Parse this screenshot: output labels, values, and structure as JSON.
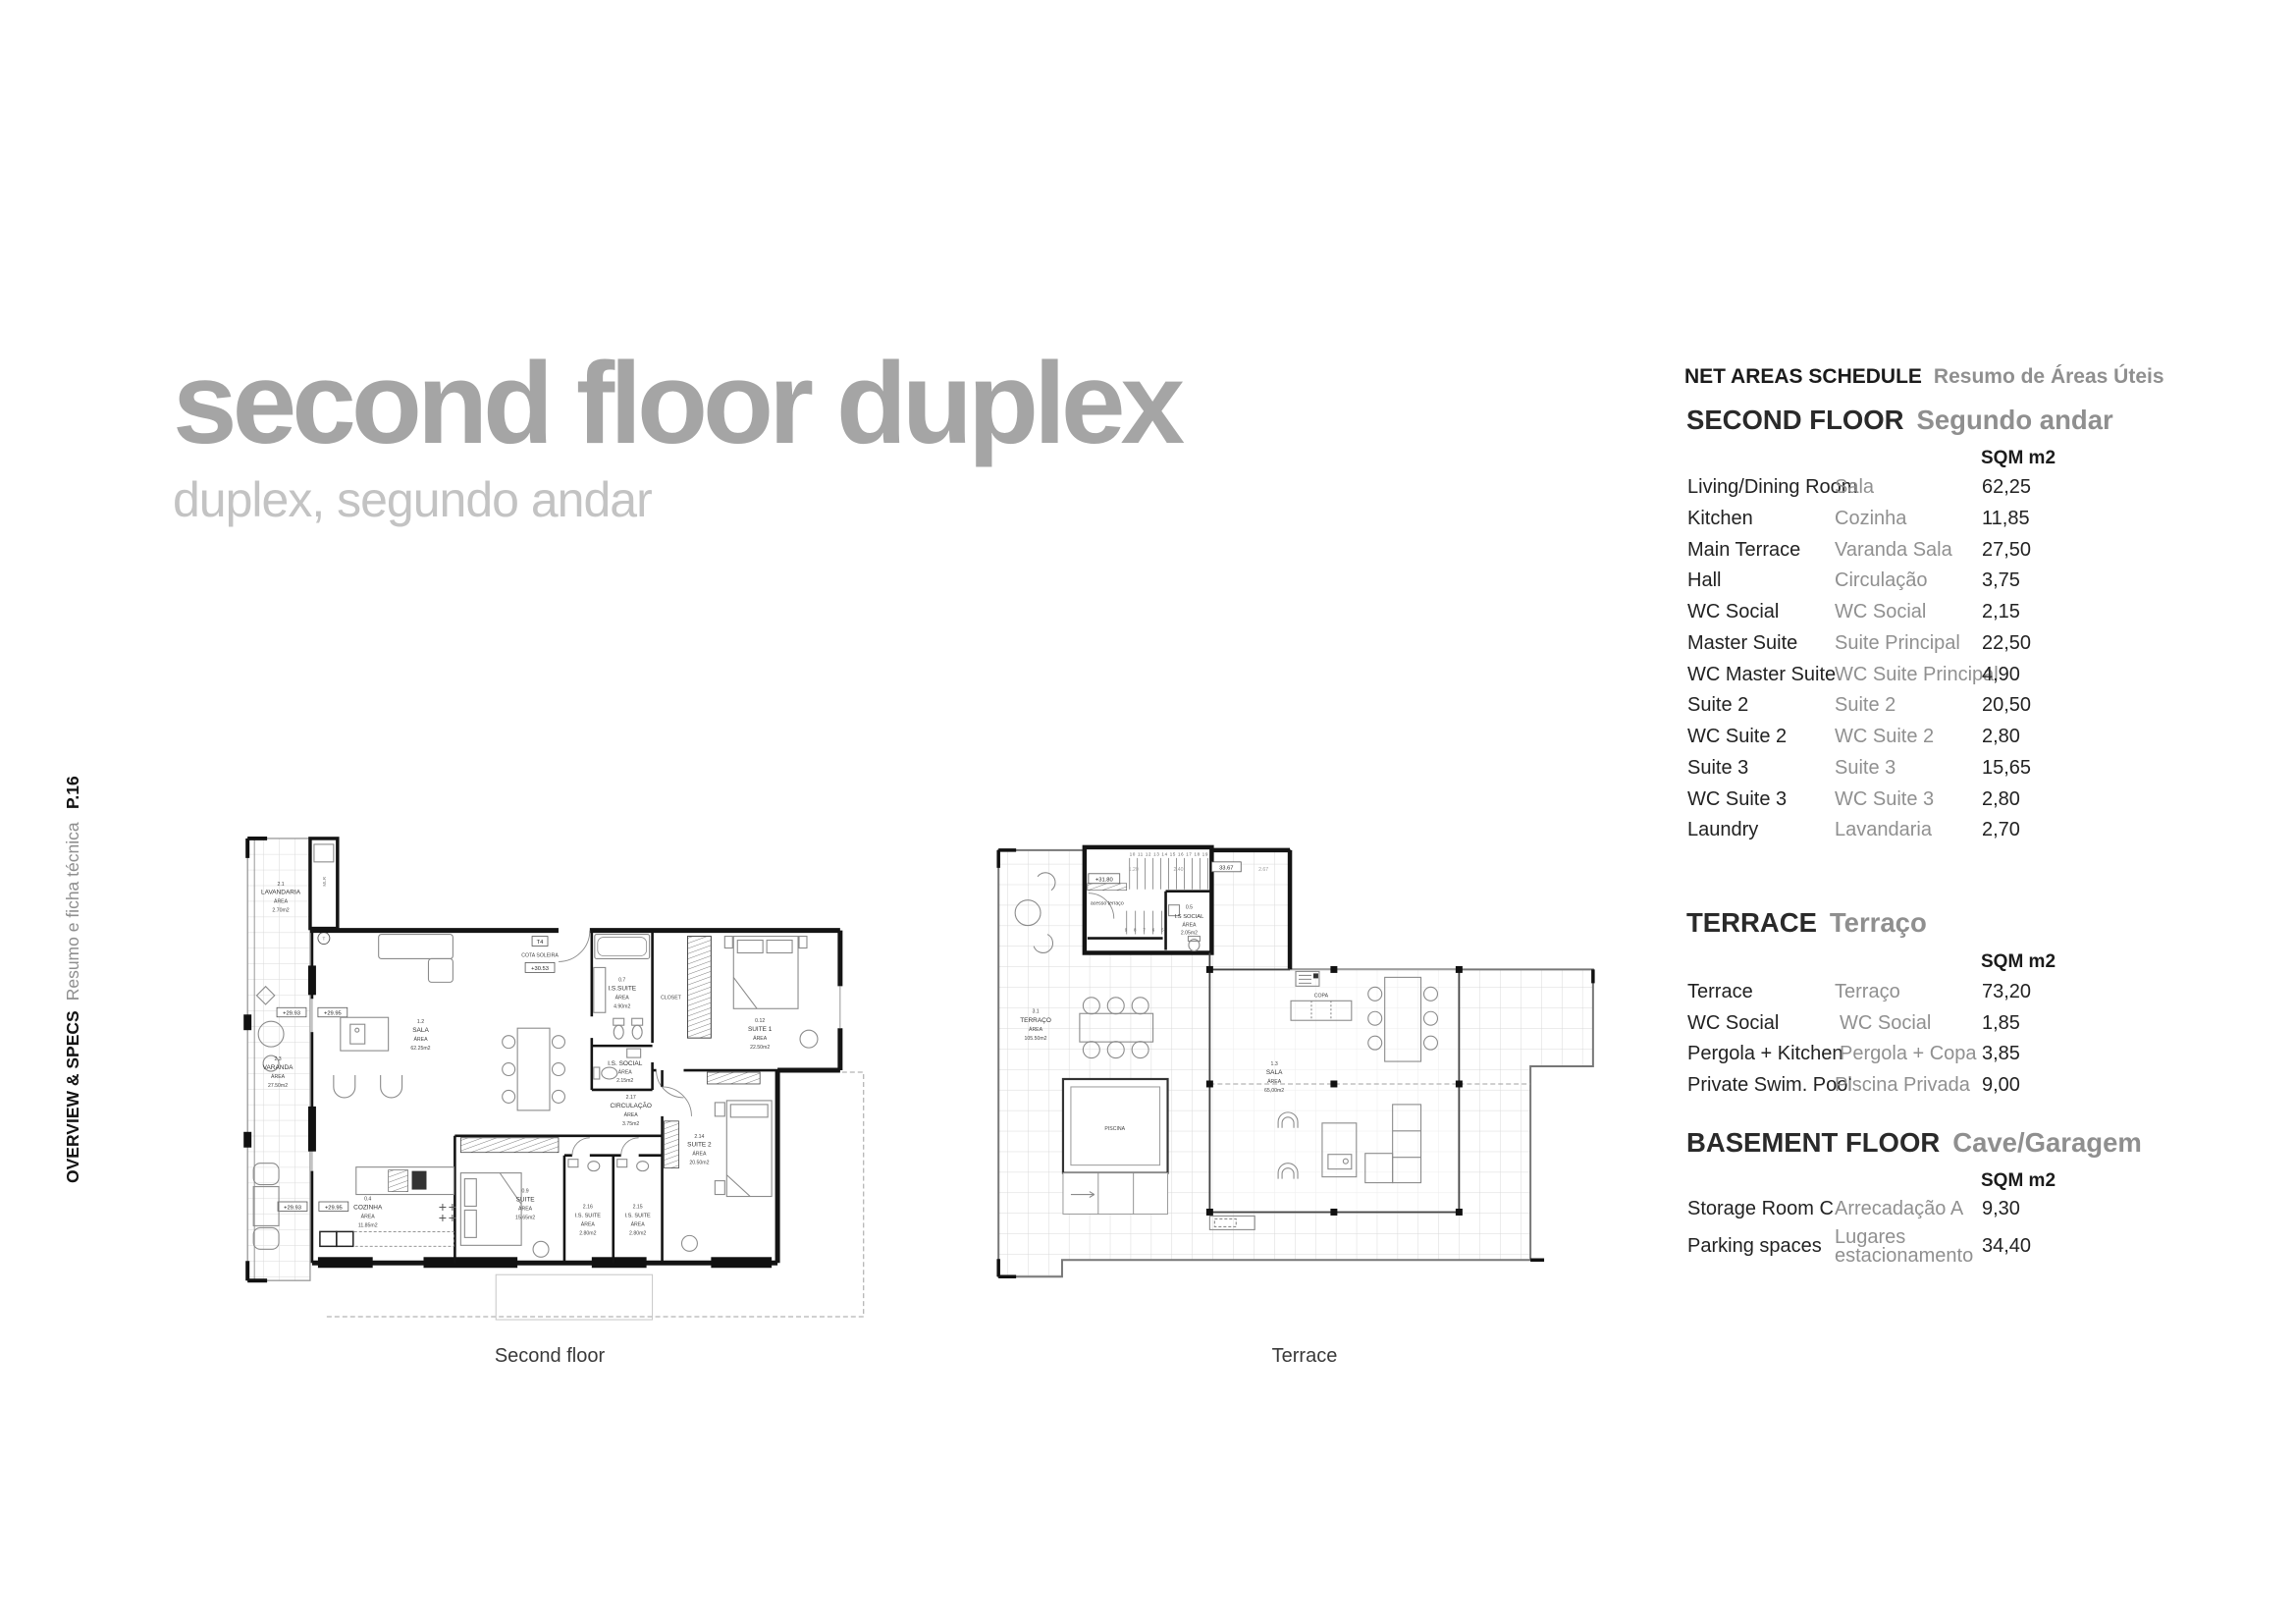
{
  "page": {
    "title": "second floor duplex",
    "subtitle": "duplex, segundo andar",
    "page_number": "P.16",
    "section_label": "OVERVIEW & SPECS",
    "section_label_pt": "Resumo e ficha técnica"
  },
  "colors": {
    "title_gray": "#a5a5a5",
    "subtitle_gray": "#c3c3c3",
    "text_black": "#1b1b1b",
    "text_gray": "#909090"
  },
  "schedule": {
    "heading": "NET AREAS SCHEDULE",
    "heading_pt": "Resumo de Áreas Úteis",
    "sections": [
      {
        "title": "SECOND FLOOR",
        "title_pt": "Segundo andar",
        "unit_header": "SQM m2",
        "rows": [
          {
            "en": "Living/Dining Room",
            "pt": "Sala",
            "sqm": "62,25"
          },
          {
            "en": "Kitchen",
            "pt": "Cozinha",
            "sqm": "11,85"
          },
          {
            "en": "Main Terrace",
            "pt": "Varanda Sala",
            "sqm": "27,50"
          },
          {
            "en": "Hall",
            "pt": "Circulação",
            "sqm": "3,75"
          },
          {
            "en": "WC Social",
            "pt": "WC Social",
            "sqm": "2,15"
          },
          {
            "en": "Master Suite",
            "pt": "Suite Principal",
            "sqm": "22,50"
          },
          {
            "en": "WC Master Suite",
            "pt": "WC Suite Principal",
            "sqm": "4,90"
          },
          {
            "en": "Suite 2",
            "pt": "Suite 2",
            "sqm": "20,50"
          },
          {
            "en": "WC Suite 2",
            "pt": "WC Suite 2",
            "sqm": "2,80"
          },
          {
            "en": "Suite 3",
            "pt": "Suite 3",
            "sqm": "15,65"
          },
          {
            "en": "WC Suite 3",
            "pt": "WC Suite 3",
            "sqm": "2,80"
          },
          {
            "en": "Laundry",
            "pt": "Lavandaria",
            "sqm": "2,70"
          }
        ]
      },
      {
        "title": "TERRACE",
        "title_pt": "Terraço",
        "unit_header": "SQM m2",
        "rows": [
          {
            "en": "Terrace",
            "pt": "Terraço",
            "sqm": "73,20"
          },
          {
            "en": "WC Social",
            "pt": "WC Social",
            "sqm": "1,85"
          },
          {
            "en": "Pergola + Kitchen",
            "pt": "Pergola + Copa",
            "sqm": "3,85"
          },
          {
            "en": "Private Swim. Pool",
            "pt": "Piscina Privada",
            "sqm": "9,00"
          }
        ]
      },
      {
        "title": "BASEMENT FLOOR",
        "title_pt": "Cave/Garagem",
        "unit_header": "SQM m2",
        "rows": [
          {
            "en": "Storage Room C",
            "pt": "Arrecadação A",
            "sqm": "9,30"
          },
          {
            "en": "Parking spaces",
            "pt": "Lugares estacionamento",
            "sqm": "34,40"
          }
        ]
      }
    ]
  },
  "plans": {
    "second_floor": {
      "caption": "Second floor",
      "labels": {
        "area_word": "ÁREA",
        "lavandaria_num": "2.1",
        "lavandaria": "LAVANDARIA",
        "lavandaria_sqm": "2.70m2",
        "mlr": "MLR",
        "t_mark": "T",
        "varanda_num": "2.3",
        "varanda": "VARANDA",
        "varanda_sqm": "27.50m2",
        "sala_num": "1.2",
        "sala": "SALA",
        "sala_sqm": "62.25m2",
        "t4": "T4",
        "cota": "COTA SOLEIRA",
        "cota_val": "+30.53",
        "lv_a": "+29.93",
        "lv_b": "+29.95",
        "is_suite_num": "0.7",
        "is_suite": "I.S.SUITE",
        "is_suite_sqm": "4.90m2",
        "closet": "CLOSET",
        "suite1_num": "0.12",
        "suite1": "SUITE 1",
        "suite1_sqm": "22.50m2",
        "is_social": "I.S. SOCIAL",
        "is_social_sqm": "2.15m2",
        "circ_num": "2.17",
        "circ": "CIRCULAÇÃO",
        "circ_sqm": "3.75m2",
        "cozinha_num": "0.4",
        "cozinha": "COZINHA",
        "cozinha_sqm": "11.85m2",
        "suite9_num": "0.9",
        "suite9": "SUITE",
        "suite9_sqm": "15.65m2",
        "is2_num": "2.16",
        "is2": "I.S. SUITE",
        "is2_sqm": "2.80m2",
        "is3_num": "2.15",
        "is3": "I.S. SUITE",
        "is3_sqm": "2.80m2",
        "suite2_num": "2.14",
        "suite2": "SUITE 2",
        "suite2_sqm": "20.50m2"
      }
    },
    "terrace": {
      "caption": "Terrace",
      "labels": {
        "area_word": "ÁREA",
        "terraco_num": "3.1",
        "terraco": "TERRAÇO",
        "terraco_sqm": "105.50m2",
        "sala_num": "1.3",
        "sala": "SALA",
        "sala_sqm": "65,00m2",
        "copa": "COPA",
        "piscina": "PISCINA",
        "acesso": "acesso  terraço",
        "is_social_num": "0.5",
        "is_social": "I.S SOCIAL",
        "is_social_sqm": "2.05m2",
        "lv": "+31.80",
        "dim_120": "1.20",
        "dim_240": "2.40",
        "dim_3367": "33.67",
        "dim_267": "2.67",
        "stairs_upper": "10 11 12 13 14 15 16 17 18 19",
        "stairs_lower": "9 8 7 6 5"
      }
    }
  }
}
